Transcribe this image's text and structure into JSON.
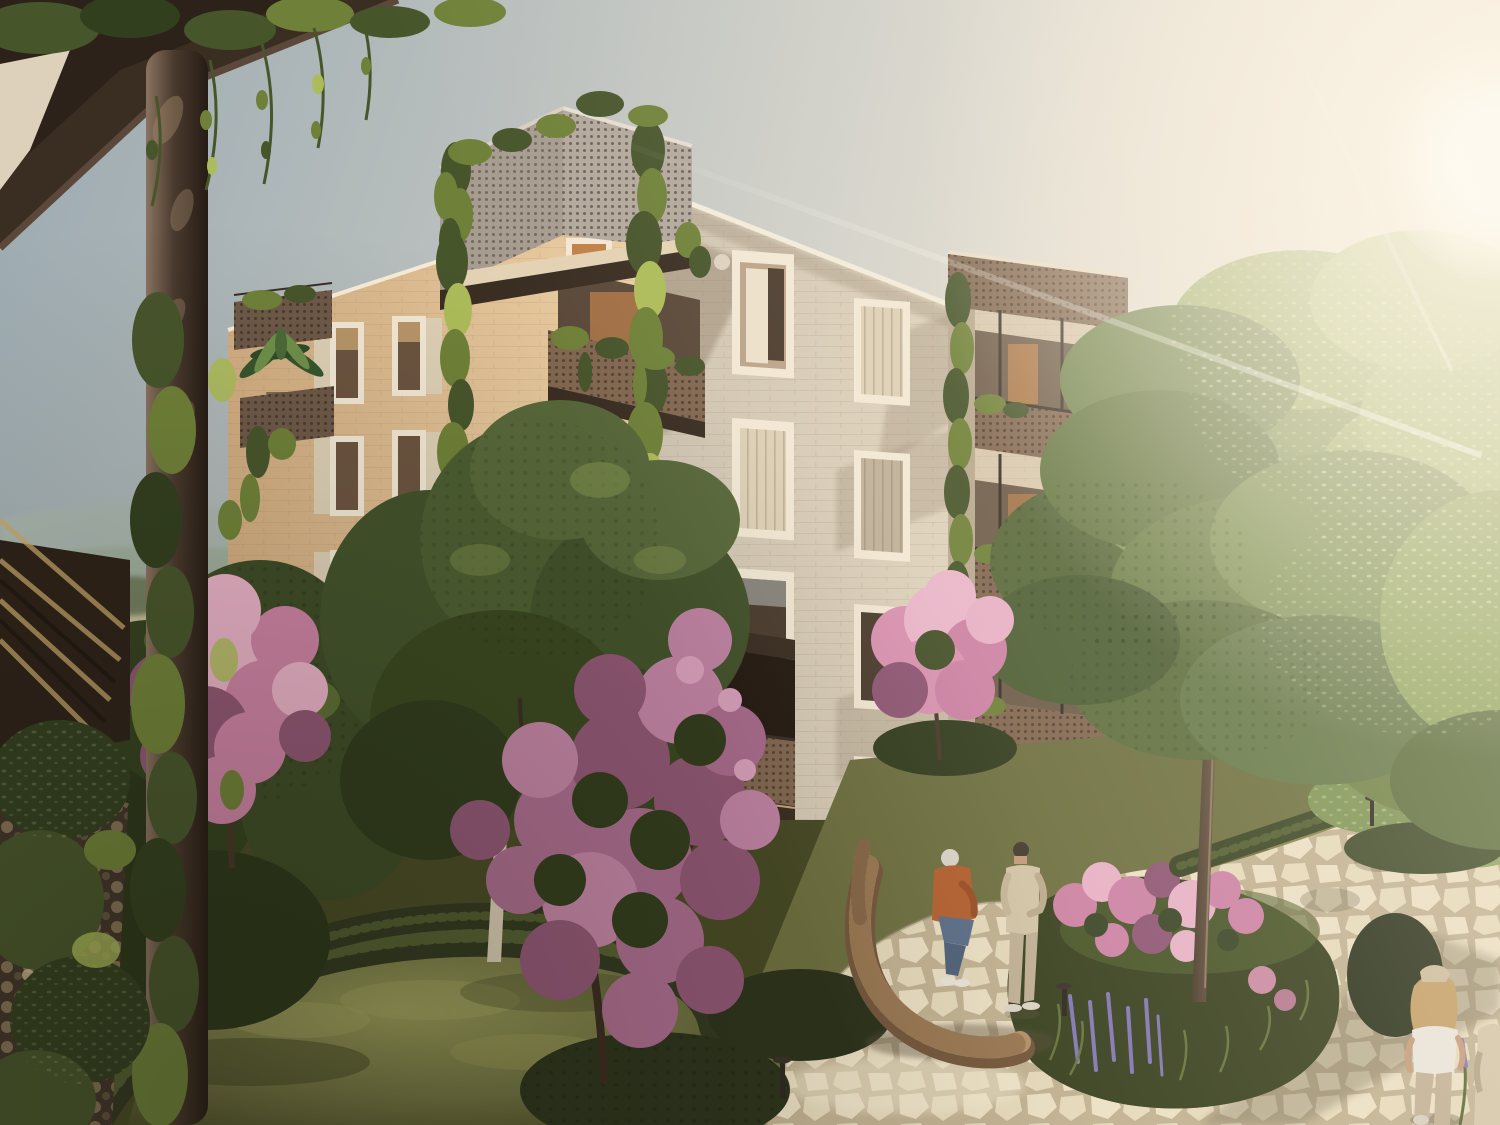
{
  "meta": {
    "type": "architectural-exterior-rendering",
    "caption": "Sunlit residential courtyard: a four-storey apartment building with perforated metal balconies overgrown with climbing vines, flowering pink trees, lawns, hedges and a winding flagstone path, seen from a neighboring vine-covered balcony at golden hour",
    "width_px": 1500,
    "height_px": 1125
  },
  "scene": {
    "time_of_day": "late afternoon, sun low at upper right",
    "sun": {
      "x": 1492,
      "y": 158
    },
    "buildings": [
      {
        "name": "main-apartment-block",
        "storeys": 4,
        "facades": [
          "warm sunlit left facade",
          "cooler front facade with diagonal balcony shadows"
        ],
        "features": [
          "corner balcony stack with perforated parapets",
          "vine trellis columns",
          "cream window frames with shutters",
          "right wing with stacked perforated balconies"
        ]
      },
      {
        "name": "background-house-right",
        "features": [
          "warm lit interior",
          "wooden lounge chair on terrace"
        ]
      },
      {
        "name": "viewer-balcony-foreground",
        "features": [
          "dark soffit slab",
          "round steel column wrapped in vines",
          "perforated parapet with round holes",
          "diagonal slat screen"
        ]
      }
    ],
    "people": [
      {
        "name": "balcony-resident",
        "desc": "grey-haired woman in light denim shirt standing on first-floor balcony"
      },
      {
        "name": "seated-woman",
        "desc": "white-haired woman in rust orange jacket and jeans sitting on curved wooden bench"
      },
      {
        "name": "standing-man",
        "desc": "man in cream jacket, beige trousers and dark cap standing on the path"
      },
      {
        "name": "walking-woman",
        "desc": "blonde woman in white top and beige trousers walking away on the path"
      },
      {
        "name": "edge-figure",
        "desc": "partially visible companion at right edge"
      }
    ],
    "vegetation": [
      "climbing vines on trellises and parapets",
      "large maple-like tree over the path island",
      "pink blossom trees",
      "azalea and lupine planting island",
      "clipped hedges",
      "palm planter",
      "banana plant in pot",
      "lavender clumps"
    ],
    "furniture": [
      "curved slatted timber bench",
      "wicker balcony chair",
      "terrace armchair with grey cushions",
      "zebra-striped lounger",
      "bollard path lights"
    ],
    "landscape_background": "hazy hills, fields and a village with red roofs at left horizon"
  },
  "palette": {
    "sky_top": "#9aa9b0",
    "sky_mid": "#bfc3c0",
    "sky_low": "#e2ddd2",
    "sky_warm": "#f2eadc",
    "sun_core": "#fffdf4",
    "facade_left_lit": "#eccfa4",
    "facade_left_shade": "#d3ae82",
    "facade_front": "#d0c5b2",
    "facade_front_lit": "#e9dcc2",
    "facade_shadow": "#8d7a64",
    "frame_cream": "#f2e8d4",
    "reveal": "#bba387",
    "glass_dark": "#4a3b2d",
    "glass_warm": "#c08048",
    "shutter": "#ddd0b6",
    "shutter_shade": "#bfb098",
    "perf_light": "#a79c90",
    "perf_brown": "#826750",
    "perf_planter": "#6e5948",
    "metal_dark": "#3a2f26",
    "vine_light": "#adbc5a",
    "vine_mid": "#6f8138",
    "vine_dark": "#47552b",
    "vine_deep": "#323f1f",
    "canopy_lit": "#b0c27c",
    "canopy_mid": "#85985a",
    "canopy_dark": "#59693c",
    "pink_lit": "#e7b1c6",
    "pink_mid": "#cc82a4",
    "pink_deep": "#8f5674",
    "pink_bright": "#da92b1",
    "pink_muted": "#a86b8c",
    "lawn_lit": "#989a58",
    "lawn_mid": "#6e7040",
    "lawn_dark": "#474a24",
    "hedge": "#313820",
    "hedge_lit": "#76843f",
    "stone": "#ece0c4",
    "joint": "#c2b292",
    "stone_shade": "#6b6248",
    "wood": "#b5906a",
    "wood_dark": "#74573c",
    "bark": "#7c6750",
    "bark_dark": "#4a3a2b",
    "birch": "#d7cab1",
    "slab_dark": "#3a2d22",
    "ceiling_cream": "#e8dbc5",
    "interior_hot": "#f2d5a0",
    "interior_mid": "#c17c3a",
    "interior_deep": "#5f3a1f",
    "dist_hill": "#a9b6ae",
    "dist_hill2": "#9fae9e",
    "dist_field": "#c4bf9a",
    "dist_tree": "#6a7554",
    "near_tree_bg": "#3c4b26",
    "roof_red": "#ad5f4c",
    "house_white": "#e9e2d3",
    "skin": "#c59a7b",
    "hair_grey": "#dcd5ca",
    "denim": "#7d96a6",
    "jeans": "#5a6e88",
    "jeans_light": "#c6cbd2",
    "rust": "#b5602f",
    "jacket_cream": "#d4c5a7",
    "pants_beige": "#c1b094",
    "white_cloth": "#eae5da",
    "cap_dark": "#453a30",
    "blonde": "#c49f66",
    "lavender": "#8377b4"
  }
}
